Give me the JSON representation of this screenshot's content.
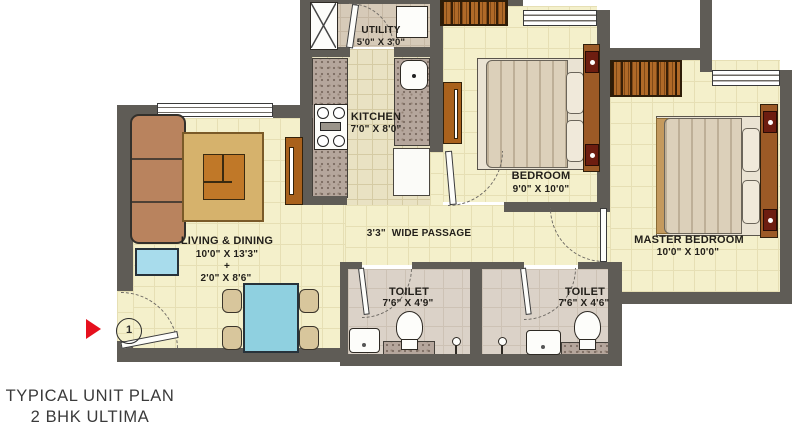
{
  "title": {
    "line1": "TYPICAL UNIT PLAN",
    "line2": "2 BHK ULTIMA"
  },
  "rooms": {
    "utility": {
      "name": "UTILITY",
      "dim": "5'0\" X 3'0\""
    },
    "kitchen": {
      "name": "KITCHEN",
      "dim": "7'0\" X 8'0\""
    },
    "living_dining": {
      "name": "LIVING & DINING",
      "dim1": "10'0\" X 13'3\"",
      "plus": "+",
      "dim2": "2'0\" X 8'6\""
    },
    "passage": {
      "name": "3'3\"  WIDE PASSAGE"
    },
    "bedroom": {
      "name": "BEDROOM",
      "dim": "9'0\" X 10'0\""
    },
    "master_bedroom": {
      "name": "MASTER BEDROOM",
      "dim": "10'0\" X 10'0\""
    },
    "toilet_1": {
      "name": "TOILET",
      "dim": "7'6\" X 4'9\""
    },
    "toilet_2": {
      "name": "TOILET",
      "dim": "7'6\" X 4'6\""
    }
  },
  "markers": {
    "entry_number": "1"
  },
  "colors": {
    "wall": "#5f5c56",
    "floor_cream": "#f4f0cb",
    "entry_arrow_red": "#e6101e",
    "water_blue": "#8fd0e0",
    "wood_brown": "#b06a28"
  }
}
